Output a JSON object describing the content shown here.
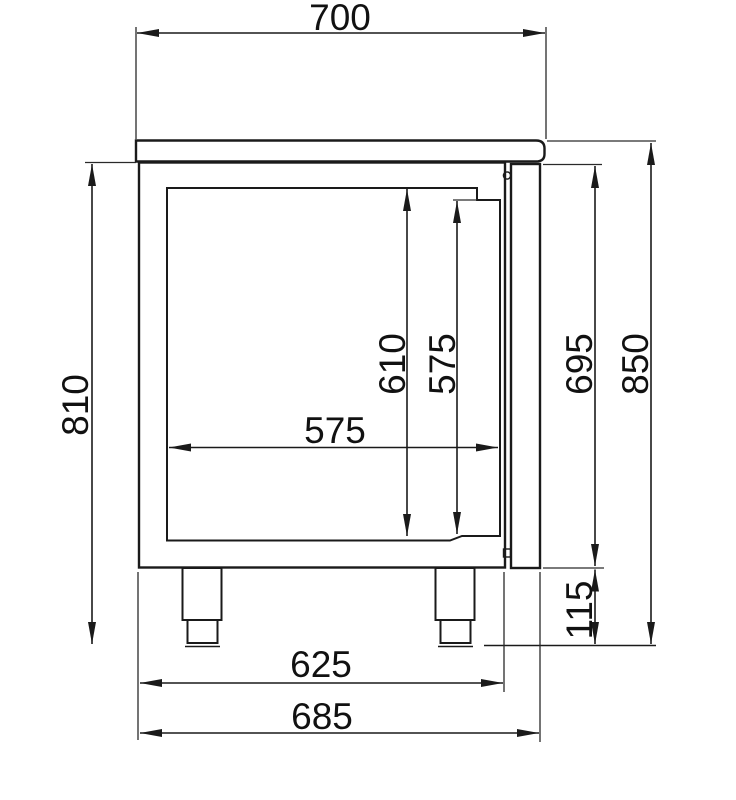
{
  "diagram": {
    "type": "technical-dimension-drawing",
    "subject": "refrigerated-counter-side-view",
    "unit": "mm",
    "colors": {
      "background": "#ffffff",
      "line": "#1a1a1a",
      "text": "#111111"
    },
    "dimensions": {
      "top_width": "700",
      "left_height": "810",
      "inner_height": "610",
      "inner_door_height": "575",
      "inner_width": "575",
      "body_right_height": "695",
      "total_height": "850",
      "leg_height": "115",
      "base_width": "625",
      "overall_depth": "685"
    }
  }
}
